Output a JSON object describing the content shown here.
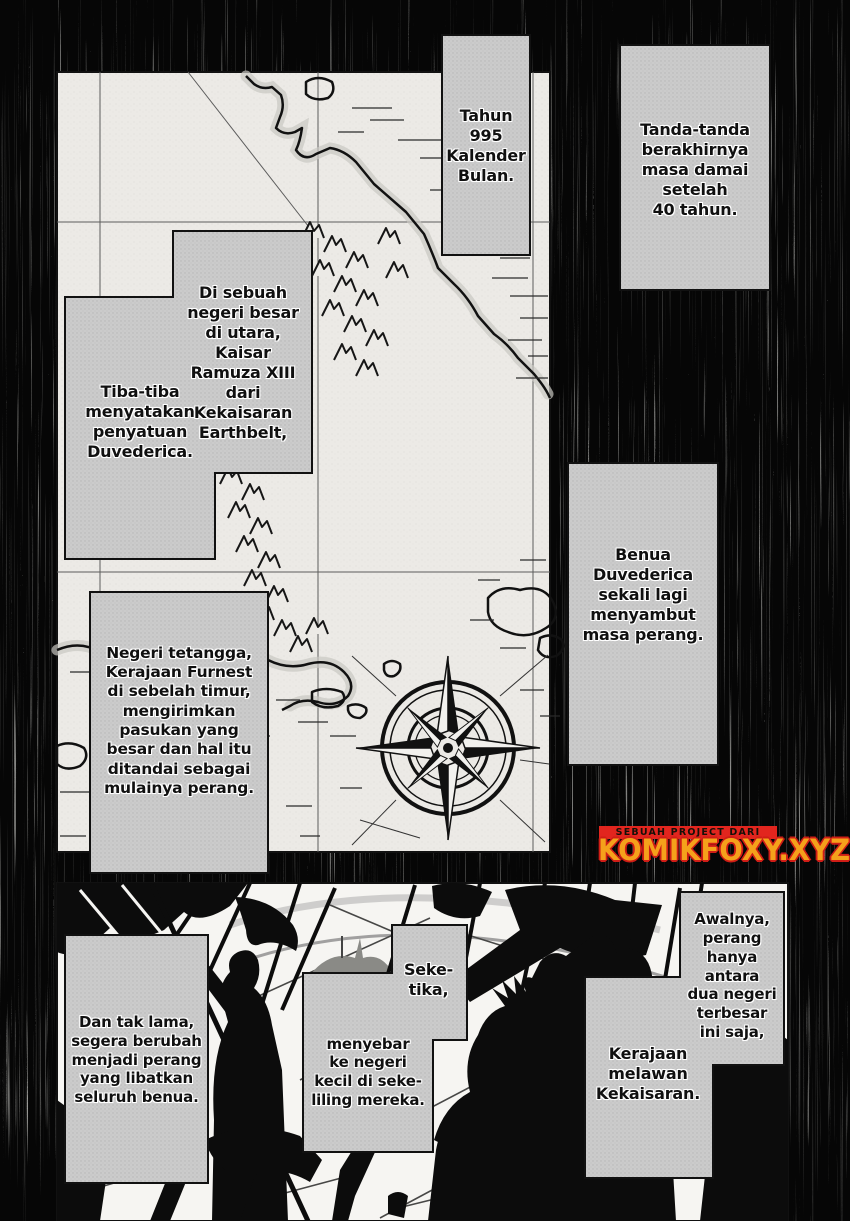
{
  "captions": {
    "tahun": "Tahun\n995\nKalender\nBulan.",
    "tanda": "Tanda-tanda\nberakhirnya\nmasa damai\nsetelah\n40 tahun.",
    "di_sebuah": "Di sebuah\nnegeri besar\ndi utara,\nKaisar\nRamuza XIII\ndari\nKekaisaran\nEarthbelt,",
    "tiba_tiba": "Tiba-tiba\nmenyatakan\npenyatuan\nDuvederica.",
    "benua": "Benua\nDuvederica\nsekali lagi\nmenyambut\nmasa perang.",
    "negeri": "Negeri tetangga,\nKerajaan Furnest\ndi sebelah timur,\nmengirimkan\npasukan yang\nbesar dan hal itu\nditandai sebagai\nmulainya perang.",
    "dan_tak_lama": "Dan tak lama,\nsegera berubah\nmenjadi perang\nyang libatkan\nseluruh benua.",
    "seketika": "Seke-\ntika,",
    "menyebar": "menyebar\nke negeri\nkecil di seke-\nliling mereka.",
    "awalnya": "Awalnya,\nperang\nhanya\nantara\ndua negeri\nterbesar\nini saja,",
    "kerajaan": "Kerajaan\nmelawan\nKekaisaran."
  },
  "banner": {
    "tagline": "SEBUAH PROJECT DARI",
    "site": "KOMIKFOXY.XYZ",
    "strip_color": "#e2251e",
    "site_color": "#f5a11b",
    "site_outline_color": "#cf1d16"
  },
  "colors": {
    "background_black": "#050505",
    "caption_tone_gray": "#cbcbcb",
    "map_paper": "#eceae6",
    "ink": "#111111"
  }
}
